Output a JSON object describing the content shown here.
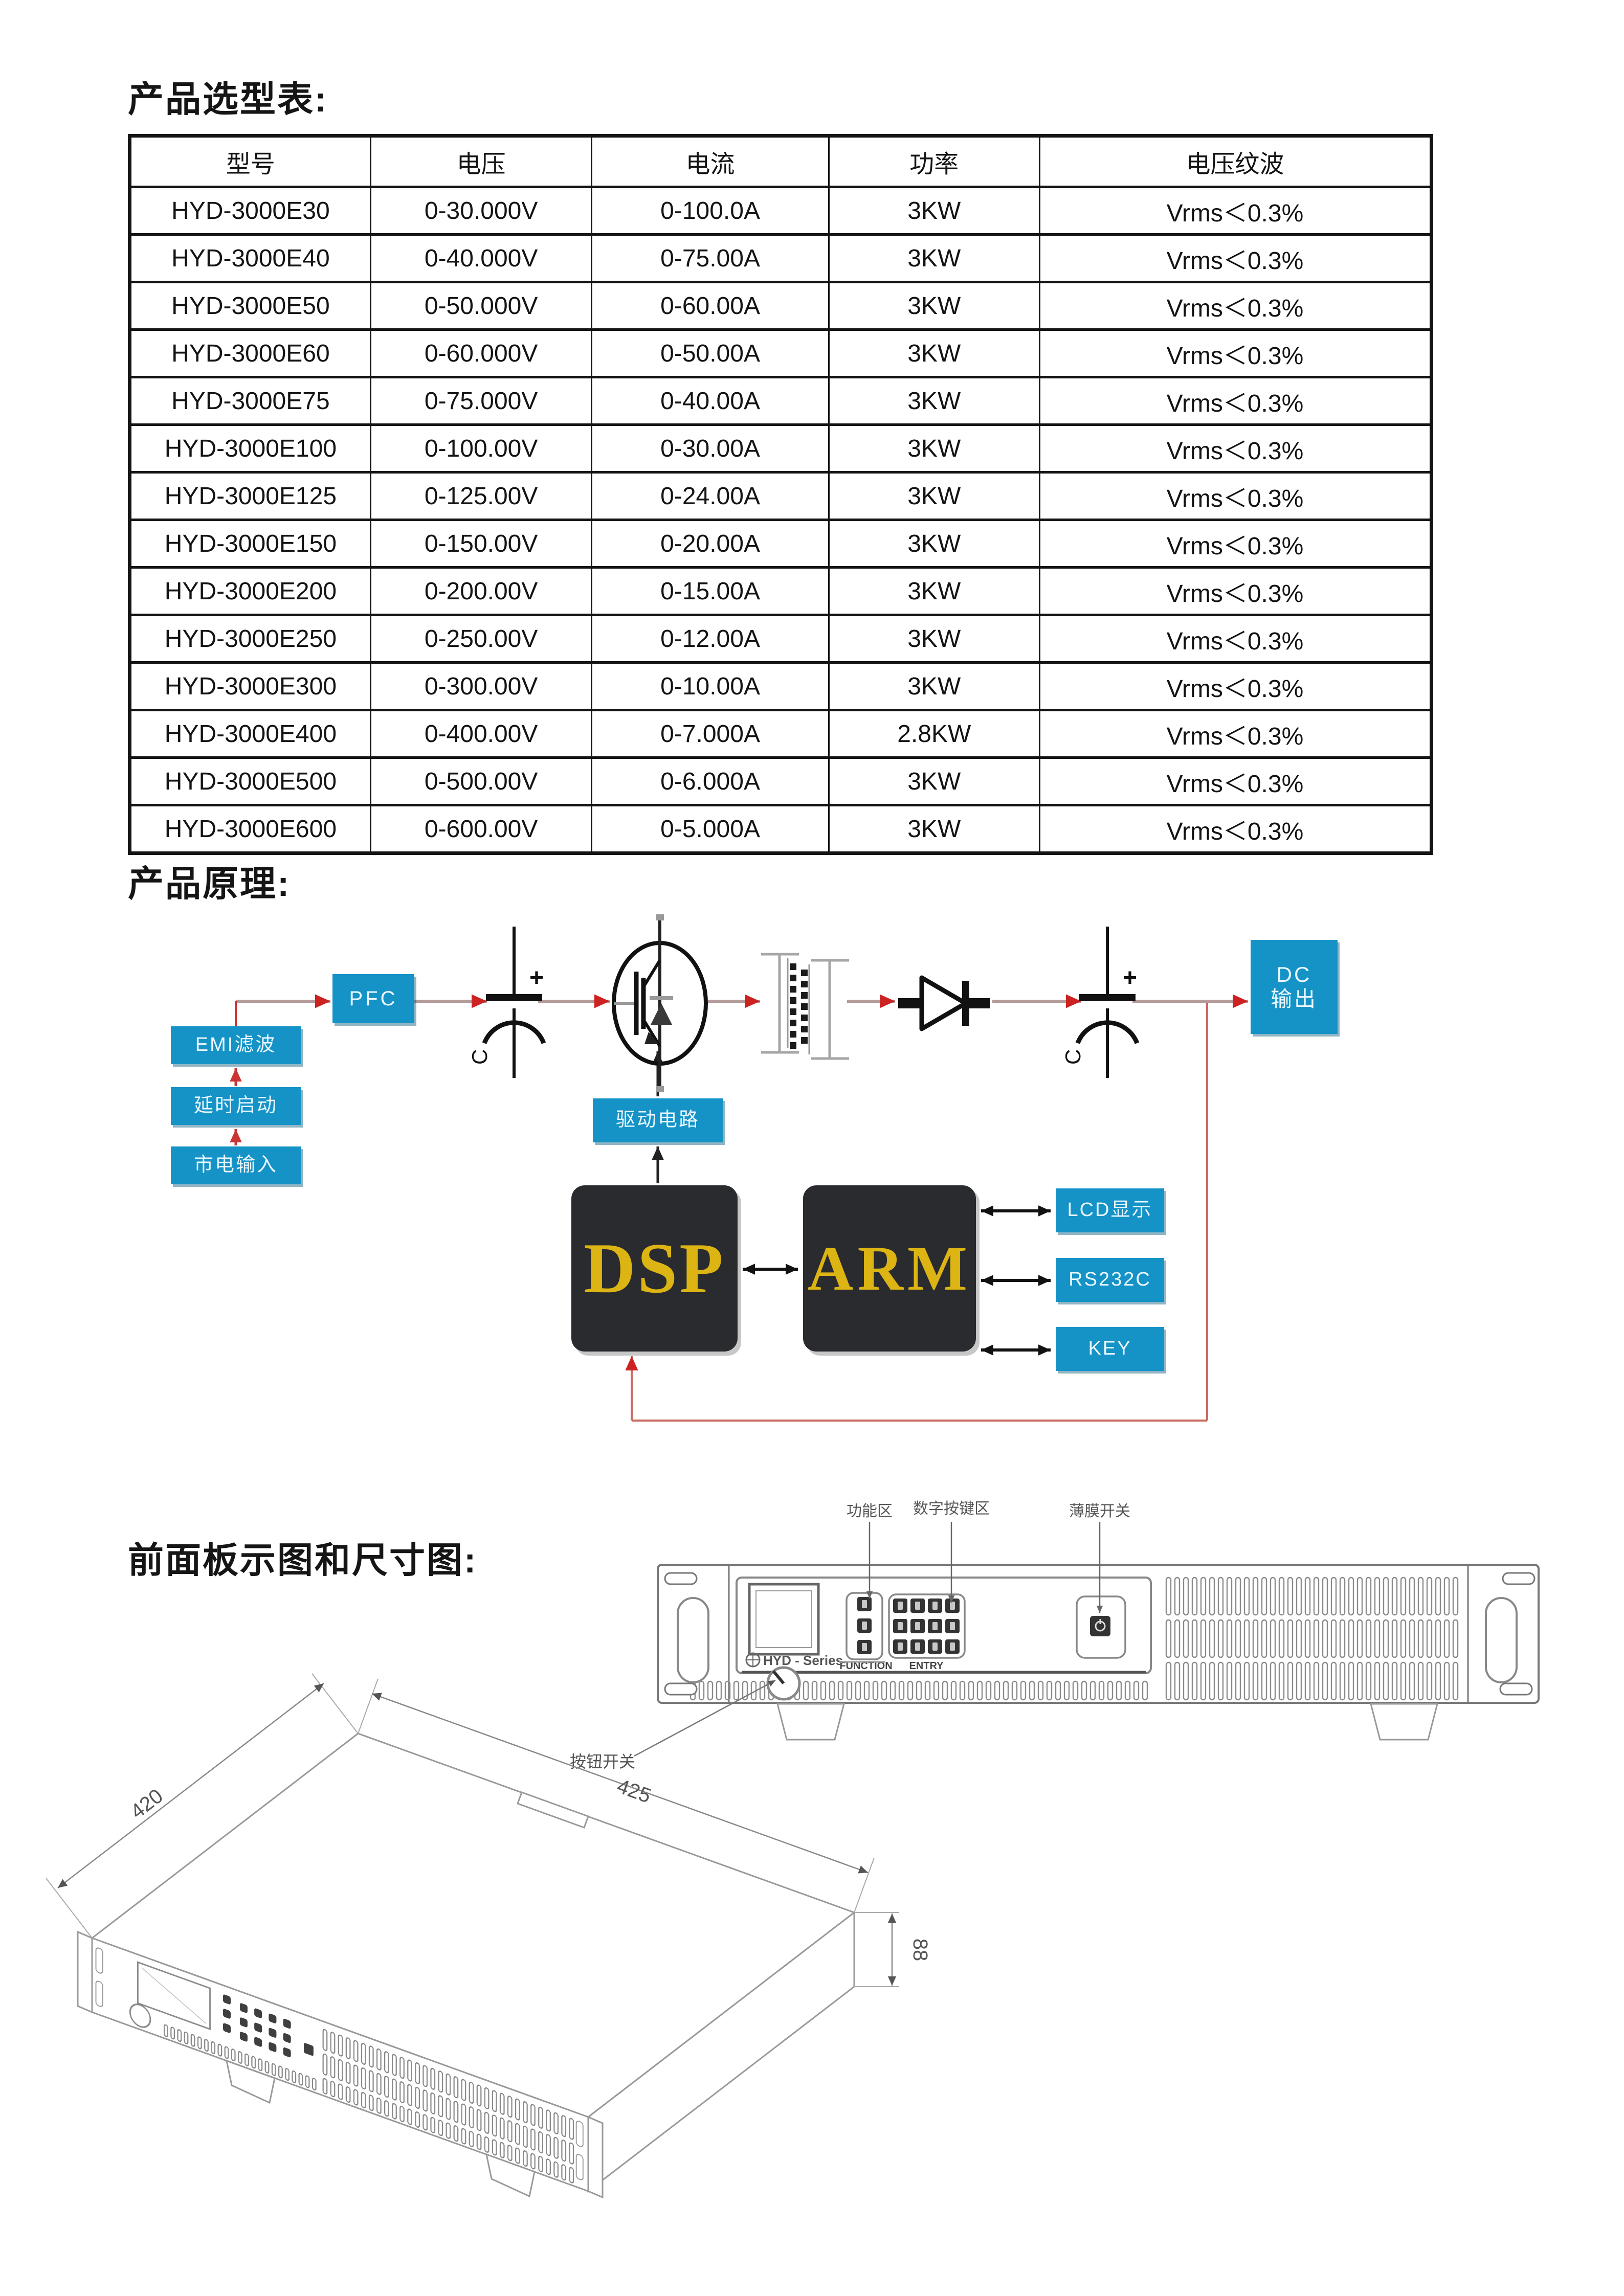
{
  "headings": {
    "selection": "产品选型表:",
    "principle": "产品原理:",
    "front_panel": "前面板示图和尺寸图:"
  },
  "selection_table": {
    "headers": [
      "型号",
      "电压",
      "电流",
      "功率",
      "电压纹波"
    ],
    "rows": [
      [
        "HYD-3000E30",
        "0-30.000V",
        "0-100.0A",
        "3KW",
        "Vrms＜0.3%"
      ],
      [
        "HYD-3000E40",
        "0-40.000V",
        "0-75.00A",
        "3KW",
        "Vrms＜0.3%"
      ],
      [
        "HYD-3000E50",
        "0-50.000V",
        "0-60.00A",
        "3KW",
        "Vrms＜0.3%"
      ],
      [
        "HYD-3000E60",
        "0-60.000V",
        "0-50.00A",
        "3KW",
        "Vrms＜0.3%"
      ],
      [
        "HYD-3000E75",
        "0-75.000V",
        "0-40.00A",
        "3KW",
        "Vrms＜0.3%"
      ],
      [
        "HYD-3000E100",
        "0-100.00V",
        "0-30.00A",
        "3KW",
        "Vrms＜0.3%"
      ],
      [
        "HYD-3000E125",
        "0-125.00V",
        "0-24.00A",
        "3KW",
        "Vrms＜0.3%"
      ],
      [
        "HYD-3000E150",
        "0-150.00V",
        "0-20.00A",
        "3KW",
        "Vrms＜0.3%"
      ],
      [
        "HYD-3000E200",
        "0-200.00V",
        "0-15.00A",
        "3KW",
        "Vrms＜0.3%"
      ],
      [
        "HYD-3000E250",
        "0-250.00V",
        "0-12.00A",
        "3KW",
        "Vrms＜0.3%"
      ],
      [
        "HYD-3000E300",
        "0-300.00V",
        "0-10.00A",
        "3KW",
        "Vrms＜0.3%"
      ],
      [
        "HYD-3000E400",
        "0-400.00V",
        "0-7.000A",
        "2.8KW",
        "Vrms＜0.3%"
      ],
      [
        "HYD-3000E500",
        "0-500.00V",
        "0-6.000A",
        "3KW",
        "Vrms＜0.3%"
      ],
      [
        "HYD-3000E600",
        "0-600.00V",
        "0-5.000A",
        "3KW",
        "Vrms＜0.3%"
      ]
    ]
  },
  "principle_diagram": {
    "blocks": {
      "mains": "市电输入",
      "delay": "延时启动",
      "emi": "EMI滤波",
      "pfc": "PFC",
      "drive": "驱动电路",
      "dsp": "DSP",
      "arm": "ARM",
      "lcd": "LCD显示",
      "rs232": "RS232C",
      "key": "KEY",
      "dc_line1": "DC",
      "dc_line2": "输出"
    },
    "symbols": {
      "cap_plus": "+",
      "cap_label": "C"
    },
    "colors": {
      "block_blue": "#1593c6",
      "block_dark": "#2a2b2e",
      "dsp_text": "#dcb414",
      "arrow_red": "#cc2222",
      "wire": "#b59a9a"
    }
  },
  "front_panel": {
    "callouts": {
      "function_area": "功能区",
      "keypad_area": "数字按键区",
      "membrane_switch": "薄膜开关",
      "knob_switch": "按钮开关"
    },
    "panel_text": {
      "function": "FUNCTION",
      "entry": "ENTRY",
      "logo": "HYD - Series"
    }
  },
  "dimension_drawing": {
    "depth": "420",
    "width": "425",
    "height": "88"
  }
}
